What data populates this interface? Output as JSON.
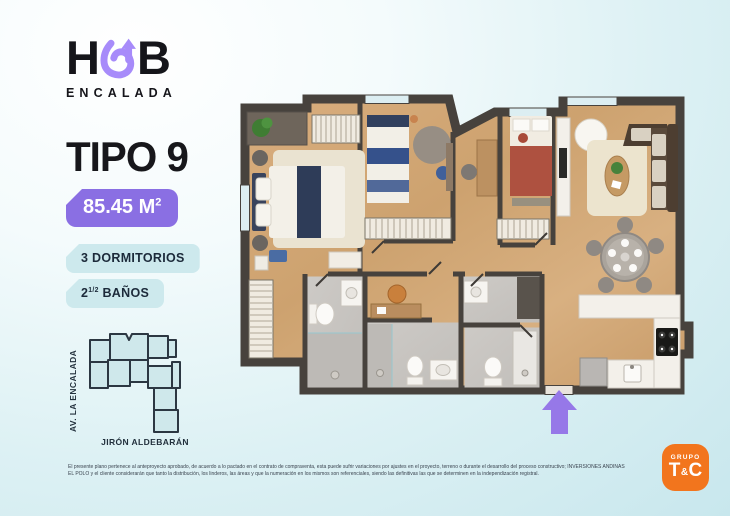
{
  "brand": {
    "prefix": "H",
    "suffix": "B",
    "subtitle": "ENCALADA",
    "loop_color": "#a78bfa"
  },
  "unit": {
    "type_label": "TIPO 9",
    "area_value": "85.45 M",
    "area_sup": "2",
    "badge_color": "#8a6fe3",
    "feature_badge_color": "#cde9ed",
    "features": [
      {
        "pre": "3 DORMITORIOS",
        "sup": "",
        "post": ""
      },
      {
        "pre": "2",
        "sup": "1/2",
        "post": " BAÑOS"
      }
    ]
  },
  "keyplan": {
    "street_left": "AV. LA ENCALADA",
    "street_bottom": "JIRÓN ALDEBARÁN",
    "highlight_color": "#9d7ee0",
    "unit_fill_color": "#cfe8eb"
  },
  "floorplan": {
    "entrance_arrow_color": "#9678e8",
    "wall_color": "#47423d",
    "wood_floor_color": "#d2a878",
    "bathroom_tile_color": "#c9c6c2"
  },
  "legal": {
    "text": "El presente plano pertenece al anteproyecto aprobado, de acuerdo a lo pactado en el contrato de compraventa, esta puede sufrir variaciones por ajustes en el proyecto, terreno o durante el desarrollo del proceso constructivo; INVERSIONES ANDINAS EL POLO y el cliente considerarán que tanto la distribución, los linderos, las áreas y que la numeración en los mismos son referenciales, siendo las definitivas las que se determinen en la independización registral."
  },
  "footer": {
    "grupo": "GRUPO",
    "t": "T",
    "amp": "&",
    "c": "C",
    "bg_color": "#f2751d"
  }
}
